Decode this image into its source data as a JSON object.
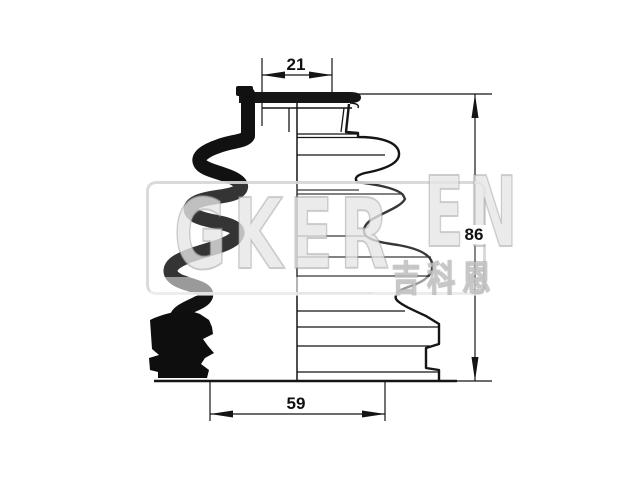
{
  "drawing": {
    "subject": "CV joint drive-shaft boot half-section technical drawing",
    "background_color": "#ffffff",
    "line_color": "#151515",
    "dimensions": {
      "top_inner_diameter": "21",
      "overall_height": "86",
      "bottom_outer_diameter": "59"
    },
    "watermark": {
      "text_parts": [
        "GKER",
        "EN"
      ],
      "text_cjk": "吉科恩",
      "color": "#d6d6d6"
    }
  }
}
